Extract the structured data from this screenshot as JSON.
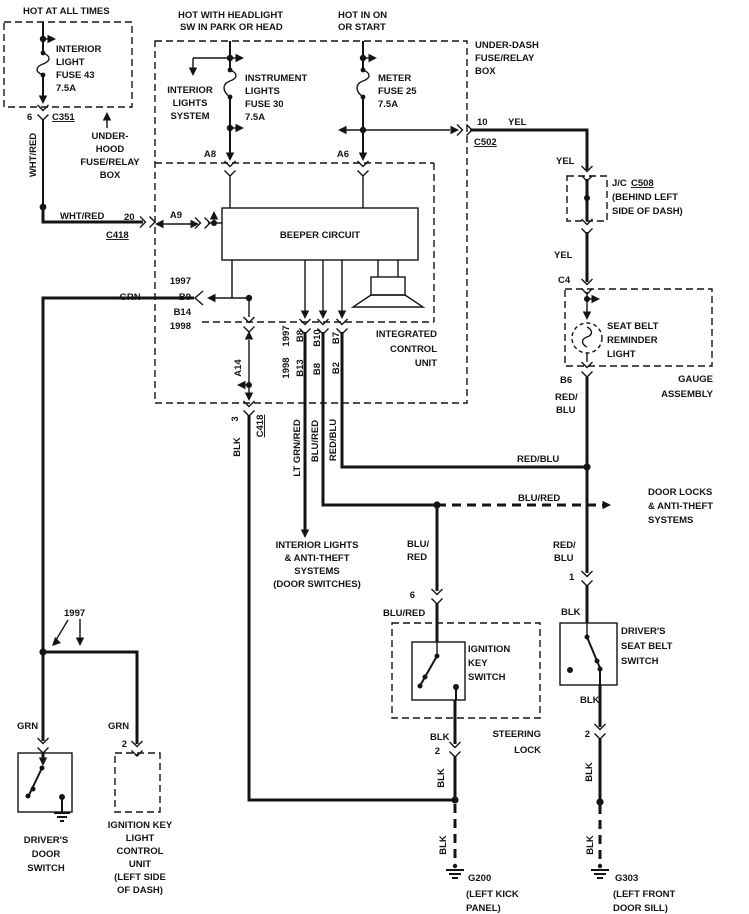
{
  "labels": {
    "hot_all_times": "HOT AT ALL TIMES",
    "hot_headlight_1": "HOT WITH HEADLIGHT",
    "hot_headlight_2": "SW IN PARK OR HEAD",
    "hot_on_start_1": "HOT IN ON",
    "hot_on_start_2": "OR START",
    "fuse43_1": "INTERIOR",
    "fuse43_2": "LIGHT",
    "fuse43_3": "FUSE 43",
    "fuse43_4": "7.5A",
    "fuse30_1": "INSTRUMENT",
    "fuse30_2": "LIGHTS",
    "fuse30_3": "FUSE 30",
    "fuse30_4": "7.5A",
    "fuse25_1": "METER",
    "fuse25_2": "FUSE 25",
    "fuse25_3": "7.5A",
    "underhood_1": "UNDER-",
    "underhood_2": "HOOD",
    "underhood_3": "FUSE/RELAY",
    "underhood_4": "BOX",
    "underdash_1": "UNDER-DASH",
    "underdash_2": "FUSE/RELAY",
    "underdash_3": "BOX",
    "int_lights_sys_1": "INTERIOR",
    "int_lights_sys_2": "LIGHTS",
    "int_lights_sys_3": "SYSTEM",
    "beeper": "BEEPER CIRCUIT",
    "icu_1": "INTEGRATED",
    "icu_2": "CONTROL",
    "icu_3": "UNIT",
    "jc": "J/C",
    "jc_ref": "C508",
    "jc_loc_1": "(BEHIND LEFT",
    "jc_loc_2": "SIDE OF DASH)",
    "sbr_1": "SEAT BELT",
    "sbr_2": "REMINDER",
    "sbr_3": "LIGHT",
    "gauge_1": "GAUGE",
    "gauge_2": "ASSEMBLY",
    "ilat_1": "INTERIOR LIGHTS",
    "ilat_2": "& ANTI-THEFT",
    "ilat_3": "SYSTEMS",
    "ilat_4": "(DOOR SWITCHES)",
    "dlat_1": "DOOR LOCKS",
    "dlat_2": "& ANTI-THEFT",
    "dlat_3": "SYSTEMS",
    "iks_1": "IGNITION",
    "iks_2": "KEY",
    "iks_3": "SWITCH",
    "steering_1": "STEERING",
    "steering_2": "LOCK",
    "dsbs_1": "DRIVER'S",
    "dsbs_2": "SEAT BELT",
    "dsbs_3": "SWITCH",
    "dds_1": "DRIVER'S",
    "dds_2": "DOOR",
    "dds_3": "SWITCH",
    "iklcu_1": "IGNITION KEY",
    "iklcu_2": "LIGHT",
    "iklcu_3": "CONTROL",
    "iklcu_4": "UNIT",
    "iklcu_5": "(LEFT SIDE",
    "iklcu_6": "OF DASH)",
    "year_jct": "1997"
  },
  "connectors": {
    "c351": "C351",
    "c351_pin": "6",
    "c418_top": "C418",
    "c418_top_pin": "20",
    "c418_bot": "C418",
    "c418_bot_pin": "3",
    "c502": "C502",
    "c502_pin": "10",
    "c4": "C4",
    "b6": "B6",
    "b9": "B9",
    "b14": "B14",
    "a8": "A8",
    "a6": "A6",
    "a9": "A9",
    "a14": "A14",
    "y97": "1997",
    "y98": "1998",
    "p97_1": "B8",
    "p97_2": "B10",
    "p97_3": "B7",
    "p98_1": "B13",
    "p98_2": "B8",
    "p98_3": "B2",
    "pin_1": "1",
    "pin_6": "6",
    "pin_2_ign": "2",
    "pin_2_sb": "2",
    "pin_2_iklcu": "2"
  },
  "wires": {
    "whtred": "WHT/RED",
    "whtred_h": "WHT/RED",
    "yel_1": "YEL",
    "yel_2": "YEL",
    "yel_3": "YEL",
    "grn_h": "GRN",
    "grn_left": "GRN",
    "grn_right": "GRN",
    "ltgrnred": "LT GRN/RED",
    "blured_icu": "BLU/RED",
    "blured_dash": "BLU/RED",
    "blured_l1": "BLU/",
    "blured_l2": "RED",
    "blured_sw": "BLU/RED",
    "redblu_icu": "RED/BLU",
    "redblu_h": "RED/BLU",
    "redblu_g1": "RED/",
    "redblu_g2": "BLU",
    "redblu_s1": "RED/",
    "redblu_s2": "BLU",
    "blk_icu": "BLK",
    "blk_ign_1": "BLK",
    "blk_ign_2": "BLK",
    "blk_g200": "BLK",
    "blk_sb_1": "BLK",
    "blk_sb_2": "BLK",
    "blk_sb_3": "BLK",
    "blk_g303": "BLK"
  },
  "grounds": {
    "g200": "G200",
    "g200_loc_1": "(LEFT KICK",
    "g200_loc_2": "PANEL)",
    "g303": "G303",
    "g303_loc_1": "(LEFT FRONT",
    "g303_loc_2": "DOOR SILL)"
  }
}
